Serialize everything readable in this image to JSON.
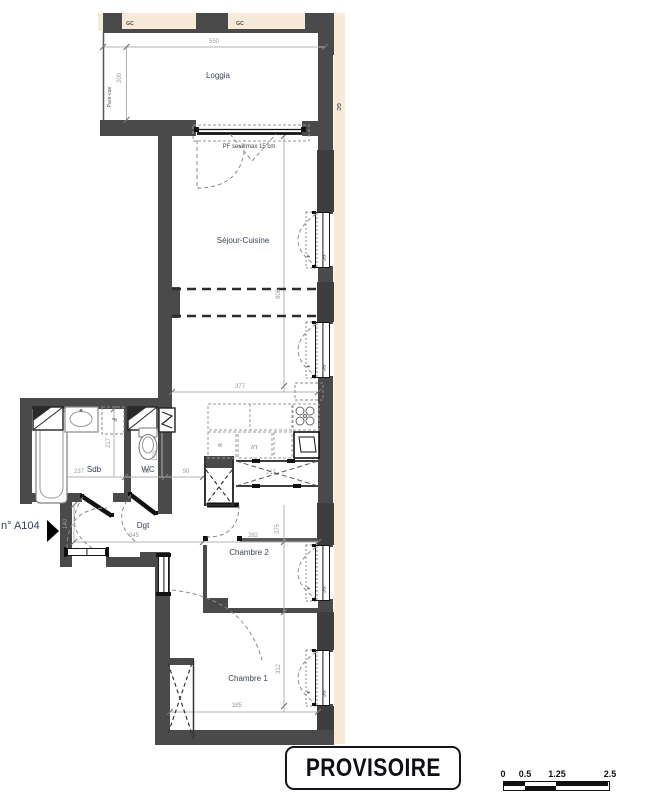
{
  "rooms": {
    "loggia": "Loggia",
    "sejour": "Séjour-Cuisine",
    "sdb": "Sdb",
    "wc": "WC",
    "dgt": "Dgt",
    "chambre2": "Chambre 2",
    "chambre1": "Chambre 1"
  },
  "notes": {
    "gc": "GC",
    "f": "F",
    "r": "R",
    "lv": "LV",
    "pare_vue": "Pare-vue",
    "pf": "PF  seuil max 15 cm",
    "unit": "n° A104"
  },
  "dims": {
    "d550": "550",
    "d200": "200",
    "d808": "808",
    "d377": "377",
    "d237": "237",
    "d98": "98",
    "d90": "90",
    "d217_sdb": "217",
    "d150": "150",
    "d140": "140",
    "d345": "345",
    "d282": "282",
    "d375": "375",
    "d385": "385",
    "d312": "312",
    "d217_kitchen": "217"
  },
  "stamp": "PROVISOIRE",
  "scale_bar": {
    "t0": "0",
    "t1": "0.5",
    "t2": "1.25",
    "t3": "2.5"
  },
  "colors": {
    "wall": "#4a4a4a",
    "wall_dark": "#3e3e3e",
    "facade": "#f7ead9",
    "dim_text": "#9b9b9b",
    "room_text": "#3a4558",
    "line_black": "#161616"
  }
}
